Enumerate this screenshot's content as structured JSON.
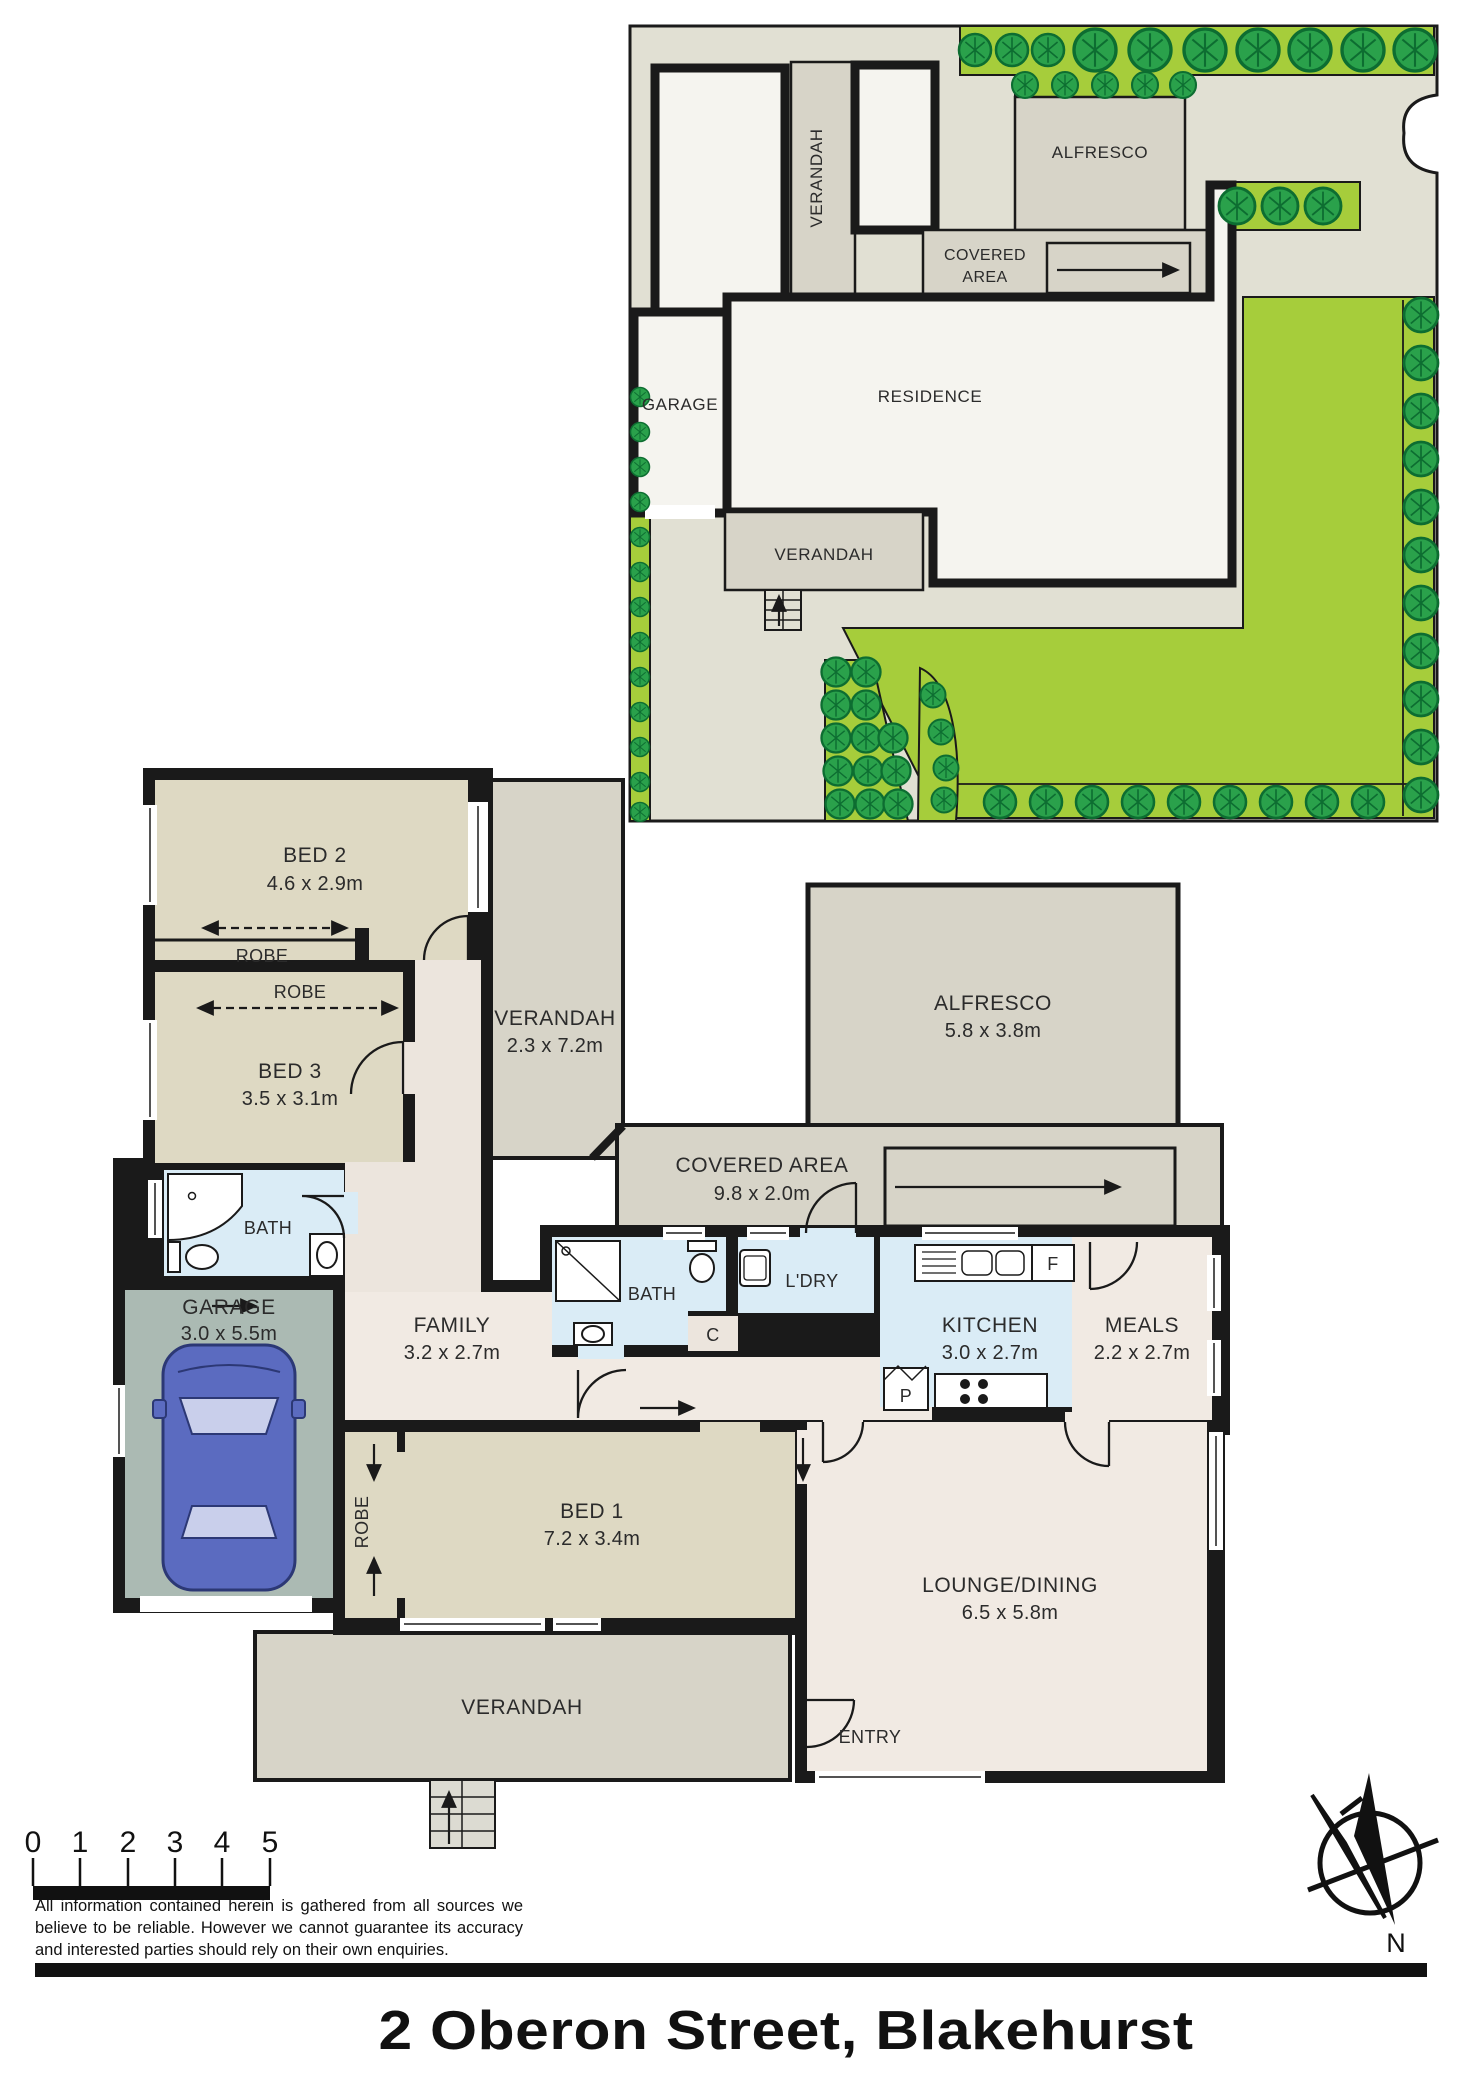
{
  "page": {
    "title": "2 Oberon Street, Blakehurst"
  },
  "scale_bar": {
    "labels": [
      "0",
      "1",
      "2",
      "3",
      "4",
      "5"
    ]
  },
  "disclaimer": "All information contained herein is gathered from all sources we believe to be reliable. However we cannot guarantee its accuracy and interested parties should rely on their own enquiries.",
  "compass": {
    "north_label": "N"
  },
  "site_plan": {
    "residence_label": "RESIDENCE",
    "garage_label": "GARAGE",
    "verandah_side_label": "VERANDAH",
    "verandah_front_label": "VERANDAH",
    "alfresco_label": "ALFRESCO",
    "covered_area_line1": "COVERED",
    "covered_area_line2": "AREA"
  },
  "floor_plan": {
    "bed2_name": "BED 2",
    "bed2_dims": "4.6 x 2.9m",
    "robe_bed2_label": "ROBE",
    "robe_bed3_label": "ROBE",
    "bed3_name": "BED 3",
    "bed3_dims": "3.5 x 3.1m",
    "bath_left_label": "BATH",
    "garage_name": "GARAGE",
    "garage_dims": "3.0 x 5.5m",
    "verandah_side_name": "VERANDAH",
    "verandah_side_dims": "2.3 x 7.2m",
    "alfresco_name": "ALFRESCO",
    "alfresco_dims": "5.8 x 3.8m",
    "covered_area_name": "COVERED AREA",
    "covered_area_dims": "9.8 x 2.0m",
    "bath_mid_label": "BATH",
    "cupboard_label": "C",
    "laundry_label": "L'DRY",
    "fridge_label": "F",
    "pantry_label": "P",
    "kitchen_name": "KITCHEN",
    "kitchen_dims": "3.0 x 2.7m",
    "meals_name": "MEALS",
    "meals_dims": "2.2 x 2.7m",
    "family_name": "FAMILY",
    "family_dims": "3.2 x 2.7m",
    "robe_bed1_label": "ROBE",
    "bed1_name": "BED 1",
    "bed1_dims": "7.2 x 3.4m",
    "lounge_name": "LOUNGE/DINING",
    "lounge_dims": "6.5 x 5.8m",
    "entry_label": "ENTRY",
    "verandah_front_label": "VERANDAH"
  },
  "colors": {
    "wall": "#1a1a1a",
    "lawn_green": "#a6cd3b",
    "tree_green": "#2aa14b",
    "paving": "#e1e0d3",
    "bedroom_fill": "#ded9c3",
    "living_fill": "#f1eae3",
    "wet_area_fill": "#daecf6",
    "outdoor_fill": "#d7d4c8",
    "garage_fill": "#abbab3",
    "car_blue": "#5b6bc0"
  }
}
